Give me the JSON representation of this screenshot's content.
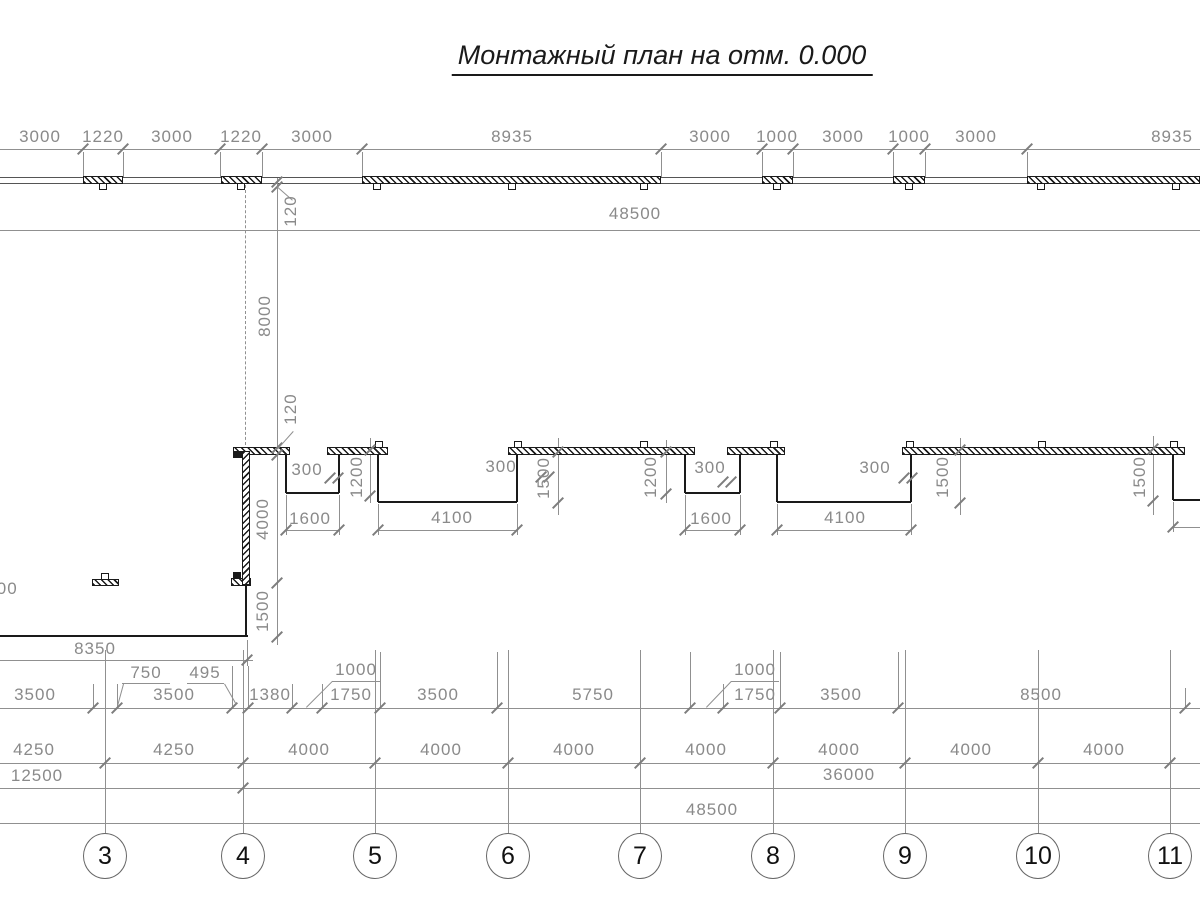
{
  "title": {
    "text": "Монтажный план на отм. 0.000",
    "x": 662,
    "y": 40
  },
  "colors": {
    "line": "#909090",
    "tick": "#7d7d7d",
    "text": "#8a8a8a",
    "wall": "#1a1a1a",
    "wall_edge": "#555555",
    "bubble_border": "#666666",
    "bubble_text": "#111111"
  },
  "drawing": {
    "gray_hlines": [
      [
        0,
        149,
        1200
      ],
      [
        0,
        230,
        1200
      ],
      [
        0,
        660,
        253
      ],
      [
        0,
        708,
        1200
      ],
      [
        0,
        763,
        1200
      ],
      [
        0,
        788,
        1200
      ],
      [
        0,
        823,
        1200
      ],
      [
        286,
        530,
        339
      ],
      [
        378,
        530,
        517
      ],
      [
        685,
        530,
        740
      ],
      [
        777,
        530,
        911
      ],
      [
        1173,
        527,
        1200
      ],
      [
        122,
        683,
        170
      ],
      [
        187,
        683,
        224
      ],
      [
        332,
        681,
        380
      ],
      [
        731,
        681,
        779
      ]
    ],
    "dark_hlines": [
      [
        0,
        177,
        1200
      ],
      [
        0,
        183,
        1200
      ]
    ],
    "gray_vlines": [
      [
        83,
        152,
        177
      ],
      [
        123,
        152,
        177
      ],
      [
        220,
        152,
        177
      ],
      [
        262,
        152,
        177
      ],
      [
        362,
        152,
        177
      ],
      [
        661,
        152,
        177
      ],
      [
        762,
        152,
        177
      ],
      [
        793,
        152,
        177
      ],
      [
        893,
        152,
        177
      ],
      [
        925,
        152,
        177
      ],
      [
        1027,
        152,
        177
      ],
      [
        277,
        178,
        645
      ],
      [
        370,
        438,
        503
      ],
      [
        558,
        438,
        515
      ],
      [
        666,
        440,
        503
      ],
      [
        960,
        438,
        515
      ],
      [
        1153,
        436,
        515
      ],
      [
        286,
        495,
        535
      ],
      [
        339,
        495,
        535
      ],
      [
        378,
        504,
        535
      ],
      [
        517,
        504,
        535
      ],
      [
        685,
        495,
        535
      ],
      [
        740,
        495,
        535
      ],
      [
        777,
        504,
        535
      ],
      [
        911,
        504,
        535
      ],
      [
        1173,
        502,
        532
      ],
      [
        247,
        640,
        666
      ],
      [
        93,
        684,
        708
      ],
      [
        117,
        684,
        708
      ],
      [
        232,
        666,
        708
      ],
      [
        248,
        666,
        708
      ],
      [
        292,
        684,
        708
      ],
      [
        322,
        684,
        708
      ],
      [
        380,
        652,
        708
      ],
      [
        497,
        652,
        708
      ],
      [
        690,
        652,
        708
      ],
      [
        723,
        684,
        708
      ],
      [
        780,
        652,
        708
      ],
      [
        898,
        652,
        708
      ],
      [
        1185,
        688,
        708
      ],
      [
        105,
        650,
        833
      ],
      [
        243,
        650,
        833
      ],
      [
        375,
        650,
        833
      ],
      [
        508,
        650,
        833
      ],
      [
        640,
        650,
        833
      ],
      [
        773,
        650,
        833
      ],
      [
        905,
        650,
        833
      ],
      [
        1038,
        650,
        833
      ],
      [
        1170,
        650,
        833
      ]
    ],
    "dash_vlines": [
      [
        245,
        185,
        450
      ]
    ],
    "wall_hlines": [
      [
        286,
        493,
        339
      ],
      [
        378,
        502,
        517
      ],
      [
        685,
        493,
        740
      ],
      [
        777,
        502,
        911
      ],
      [
        1173,
        500,
        1200
      ],
      [
        0,
        636,
        248
      ]
    ],
    "wall_vlines": [
      [
        286,
        454,
        493
      ],
      [
        339,
        454,
        493
      ],
      [
        378,
        454,
        502
      ],
      [
        517,
        454,
        502
      ],
      [
        685,
        454,
        493
      ],
      [
        740,
        454,
        493
      ],
      [
        777,
        454,
        502
      ],
      [
        911,
        454,
        502
      ],
      [
        1173,
        454,
        500
      ],
      [
        246,
        586,
        636
      ]
    ],
    "plates_top": [
      {
        "x1": 83,
        "x2": 123,
        "y": 176,
        "h": 8,
        "tabs": [
          103
        ],
        "side": "below"
      },
      {
        "x1": 221,
        "x2": 262,
        "y": 176,
        "h": 8,
        "tabs": [
          241
        ],
        "side": "below"
      },
      {
        "x1": 362,
        "x2": 661,
        "y": 176,
        "h": 8,
        "tabs": [
          377,
          512,
          644
        ],
        "side": "below"
      },
      {
        "x1": 762,
        "x2": 793,
        "y": 176,
        "h": 8,
        "tabs": [
          777
        ],
        "side": "below"
      },
      {
        "x1": 893,
        "x2": 925,
        "y": 176,
        "h": 8,
        "tabs": [
          909
        ],
        "side": "below"
      },
      {
        "x1": 1027,
        "x2": 1200,
        "y": 176,
        "h": 8,
        "tabs": [
          1041,
          1176
        ],
        "side": "below"
      },
      {
        "x1": 233,
        "x2": 290,
        "y": 447,
        "h": 8,
        "tabs": [],
        "side": "above"
      },
      {
        "x1": 327,
        "x2": 388,
        "y": 447,
        "h": 8,
        "tabs": [
          379
        ],
        "side": "above"
      },
      {
        "x1": 508,
        "x2": 695,
        "y": 447,
        "h": 8,
        "tabs": [
          518,
          644
        ],
        "side": "above"
      },
      {
        "x1": 727,
        "x2": 785,
        "y": 447,
        "h": 8,
        "tabs": [
          774
        ],
        "side": "above"
      },
      {
        "x1": 902,
        "x2": 1185,
        "y": 447,
        "h": 8,
        "tabs": [
          910,
          1042,
          1174
        ],
        "side": "above"
      },
      {
        "x1": 92,
        "x2": 119,
        "y": 579,
        "h": 7,
        "tabs": [
          105
        ],
        "side": "above"
      },
      {
        "x1": 231,
        "x2": 251,
        "y": 578,
        "h": 8,
        "tabs": [],
        "side": "below"
      }
    ],
    "wall_rects": [
      [
        242,
        451,
        250,
        585
      ]
    ],
    "solid_rects": [
      [
        233,
        451,
        243,
        458
      ],
      [
        233,
        572,
        241,
        579
      ]
    ],
    "ticks": [
      [
        83,
        149
      ],
      [
        123,
        149
      ],
      [
        220,
        149
      ],
      [
        262,
        149
      ],
      [
        362,
        149
      ],
      [
        661,
        149
      ],
      [
        762,
        149
      ],
      [
        793,
        149
      ],
      [
        893,
        149
      ],
      [
        925,
        149
      ],
      [
        1027,
        149
      ],
      [
        277,
        182
      ],
      [
        277,
        187
      ],
      [
        277,
        448
      ],
      [
        277,
        455
      ],
      [
        277,
        583
      ],
      [
        277,
        637
      ],
      [
        370,
        450
      ],
      [
        370,
        496
      ],
      [
        558,
        452
      ],
      [
        558,
        503
      ],
      [
        666,
        452
      ],
      [
        666,
        494
      ],
      [
        960,
        450
      ],
      [
        960,
        503
      ],
      [
        1153,
        449
      ],
      [
        1153,
        501
      ],
      [
        330,
        478
      ],
      [
        338,
        478
      ],
      [
        541,
        477
      ],
      [
        549,
        477
      ],
      [
        723,
        482
      ],
      [
        731,
        482
      ],
      [
        904,
        478
      ],
      [
        912,
        478
      ],
      [
        286,
        530
      ],
      [
        339,
        530
      ],
      [
        378,
        530
      ],
      [
        517,
        530
      ],
      [
        685,
        530
      ],
      [
        740,
        530
      ],
      [
        777,
        530
      ],
      [
        911,
        530
      ],
      [
        1173,
        527
      ],
      [
        247,
        660
      ],
      [
        93,
        708
      ],
      [
        117,
        708
      ],
      [
        232,
        708
      ],
      [
        248,
        708
      ],
      [
        292,
        708
      ],
      [
        322,
        708
      ],
      [
        380,
        708
      ],
      [
        497,
        708
      ],
      [
        690,
        708
      ],
      [
        723,
        708
      ],
      [
        780,
        708
      ],
      [
        898,
        708
      ],
      [
        1185,
        708
      ],
      [
        105,
        763
      ],
      [
        243,
        763
      ],
      [
        375,
        763
      ],
      [
        508,
        763
      ],
      [
        640,
        763
      ],
      [
        773,
        763
      ],
      [
        905,
        763
      ],
      [
        1038,
        763
      ],
      [
        1170,
        763
      ],
      [
        243,
        788
      ]
    ],
    "leaders": [
      [
        277,
        186,
        293,
        200
      ],
      [
        277,
        449,
        293,
        431
      ],
      [
        117,
        706,
        123,
        684
      ],
      [
        236,
        705,
        224,
        684
      ],
      [
        306,
        707,
        332,
        681
      ],
      [
        706,
        707,
        731,
        681
      ]
    ],
    "labels": [
      {
        "t": "3000",
        "x": 40,
        "y": 137
      },
      {
        "t": "1220",
        "x": 103,
        "y": 137
      },
      {
        "t": "3000",
        "x": 172,
        "y": 137
      },
      {
        "t": "1220",
        "x": 241,
        "y": 137
      },
      {
        "t": "3000",
        "x": 312,
        "y": 137
      },
      {
        "t": "8935",
        "x": 512,
        "y": 137
      },
      {
        "t": "3000",
        "x": 710,
        "y": 137
      },
      {
        "t": "1000",
        "x": 777,
        "y": 137
      },
      {
        "t": "3000",
        "x": 843,
        "y": 137
      },
      {
        "t": "1000",
        "x": 909,
        "y": 137
      },
      {
        "t": "3000",
        "x": 976,
        "y": 137
      },
      {
        "t": "8935",
        "x": 1172,
        "y": 137
      },
      {
        "t": "48500",
        "x": 635,
        "y": 214
      },
      {
        "t": "120",
        "x": 291,
        "y": 211,
        "r": 1
      },
      {
        "t": "8000",
        "x": 265,
        "y": 316,
        "r": 1
      },
      {
        "t": "120",
        "x": 291,
        "y": 409,
        "r": 1
      },
      {
        "t": "4000",
        "x": 263,
        "y": 519,
        "r": 1
      },
      {
        "t": "1500",
        "x": 263,
        "y": 611,
        "r": 1
      },
      {
        "t": "300",
        "x": 307,
        "y": 470
      },
      {
        "t": "300",
        "x": 501,
        "y": 467
      },
      {
        "t": "300",
        "x": 710,
        "y": 468
      },
      {
        "t": "300",
        "x": 875,
        "y": 468
      },
      {
        "t": "1200",
        "x": 357,
        "y": 477,
        "r": 1
      },
      {
        "t": "1500",
        "x": 544,
        "y": 478,
        "r": 1
      },
      {
        "t": "1200",
        "x": 651,
        "y": 477,
        "r": 1
      },
      {
        "t": "1500",
        "x": 943,
        "y": 477,
        "r": 1
      },
      {
        "t": "1500",
        "x": 1140,
        "y": 477,
        "r": 1
      },
      {
        "t": "1600",
        "x": 310,
        "y": 519
      },
      {
        "t": "4100",
        "x": 452,
        "y": 518
      },
      {
        "t": "1600",
        "x": 711,
        "y": 519
      },
      {
        "t": "4100",
        "x": 845,
        "y": 518
      },
      {
        "t": "300",
        "x": 2,
        "y": 589
      },
      {
        "t": "8350",
        "x": 95,
        "y": 649
      },
      {
        "t": "750",
        "x": 146,
        "y": 673
      },
      {
        "t": "495",
        "x": 205,
        "y": 673
      },
      {
        "t": "1000",
        "x": 356,
        "y": 670
      },
      {
        "t": "1000",
        "x": 755,
        "y": 670
      },
      {
        "t": "3500",
        "x": 35,
        "y": 695
      },
      {
        "t": "3500",
        "x": 174,
        "y": 695
      },
      {
        "t": "1380",
        "x": 270,
        "y": 695
      },
      {
        "t": "1750",
        "x": 351,
        "y": 695
      },
      {
        "t": "3500",
        "x": 438,
        "y": 695
      },
      {
        "t": "5750",
        "x": 593,
        "y": 695
      },
      {
        "t": "1750",
        "x": 755,
        "y": 695
      },
      {
        "t": "3500",
        "x": 841,
        "y": 695
      },
      {
        "t": "8500",
        "x": 1041,
        "y": 695
      },
      {
        "t": "4250",
        "x": 34,
        "y": 750
      },
      {
        "t": "4250",
        "x": 174,
        "y": 750
      },
      {
        "t": "4000",
        "x": 309,
        "y": 750
      },
      {
        "t": "4000",
        "x": 441,
        "y": 750
      },
      {
        "t": "4000",
        "x": 574,
        "y": 750
      },
      {
        "t": "4000",
        "x": 706,
        "y": 750
      },
      {
        "t": "4000",
        "x": 839,
        "y": 750
      },
      {
        "t": "4000",
        "x": 971,
        "y": 750
      },
      {
        "t": "4000",
        "x": 1104,
        "y": 750
      },
      {
        "t": "12500",
        "x": 37,
        "y": 776
      },
      {
        "t": "36000",
        "x": 849,
        "y": 775
      },
      {
        "t": "48500",
        "x": 712,
        "y": 810
      }
    ],
    "bubbles": {
      "cy": 856,
      "rx": 22,
      "ry": 23,
      "items": [
        {
          "n": "3",
          "x": 105
        },
        {
          "n": "4",
          "x": 243
        },
        {
          "n": "5",
          "x": 375
        },
        {
          "n": "6",
          "x": 508
        },
        {
          "n": "7",
          "x": 640
        },
        {
          "n": "8",
          "x": 773
        },
        {
          "n": "9",
          "x": 905
        },
        {
          "n": "10",
          "x": 1038
        },
        {
          "n": "11",
          "x": 1170
        }
      ]
    }
  }
}
